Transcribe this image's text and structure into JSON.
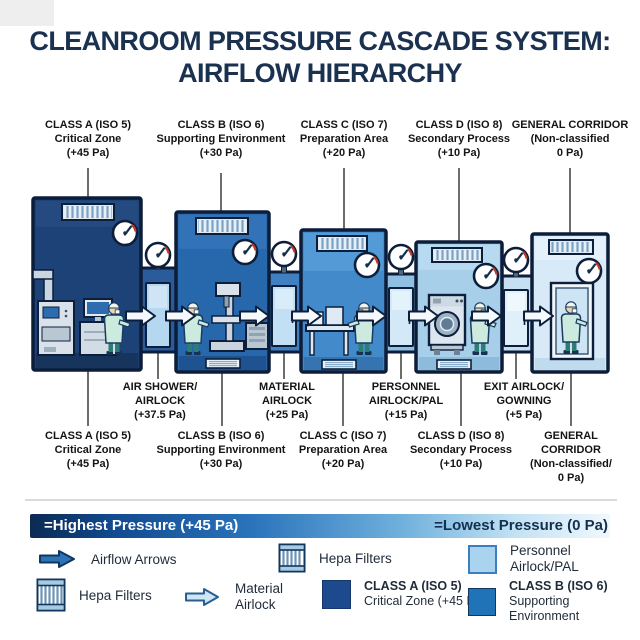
{
  "title": {
    "line1": "CLEANROOM PRESSURE CASCADE SYSTEM:",
    "line2": "AIRFLOW HIERARCHY"
  },
  "top_labels": [
    {
      "lines": [
        "CLASS A (ISO 5)",
        "Critical Zone",
        "(+45 Pa)"
      ]
    },
    {
      "lines": [
        "CLASS B (ISO 6)",
        "Supporting Environment",
        "(+30 Pa)"
      ]
    },
    {
      "lines": [
        "CLASS C (ISO 7)",
        "Preparation Area",
        "(+20 Pa)"
      ]
    },
    {
      "lines": [
        "CLASS D (ISO 8)",
        "Secondary Process",
        "(+10 Pa)"
      ]
    },
    {
      "lines": [
        "GENERAL CORRIDOR",
        "(Non-classified",
        "0 Pa)"
      ]
    }
  ],
  "airlock_labels": [
    {
      "lines": [
        "AIR SHOWER/",
        "AIRLOCK",
        "(+37.5 Pa)"
      ]
    },
    {
      "lines": [
        "MATERIAL",
        "AIRLOCK",
        "(+25 Pa)"
      ]
    },
    {
      "lines": [
        "PERSONNEL",
        "AIRLOCK/PAL",
        "(+15 Pa)"
      ]
    },
    {
      "lines": [
        "EXIT AIRLOCK/",
        "GOWNING",
        "(+5 Pa)"
      ]
    }
  ],
  "bottom_labels": [
    {
      "lines": [
        "CLASS A (ISO 5)",
        "Critical Zone",
        "(+45 Pa)"
      ]
    },
    {
      "lines": [
        "CLASS B (ISO 6)",
        "Supporting Environment",
        "(+30 Pa)"
      ]
    },
    {
      "lines": [
        "CLASS C (ISO 7)",
        "Preparation Area",
        "(+20 Pa)"
      ]
    },
    {
      "lines": [
        "CLASS D (ISO 8)",
        "Secondary Process",
        "(+10 Pa)"
      ]
    },
    {
      "lines": [
        "GENERAL",
        "CORRIDOR",
        "(Non-classified/",
        "0 Pa)"
      ]
    }
  ],
  "legend": {
    "gradient_left": "=Highest Pressure (+45 Pa)",
    "gradient_right": "=Lowest Pressure (0 Pa)",
    "airflow_arrows": "Airflow Arrows",
    "hepa_filters_1": "Hepa Filters",
    "material_line1": "Material",
    "material_line2": "Airlock",
    "hepa_filters_2": "Hepa Filters",
    "class_a_line1": "CLASS A (ISO 5)",
    "class_a_line2": "Critical Zone (+45 Pa)",
    "personnel_line1": "Personnel",
    "personnel_line2": "Airlock/PAL",
    "class_b_line1": "CLASS B (ISO 6)",
    "class_b_line2": "Supporting Environment"
  },
  "palette": {
    "class_a_room": "#1d4277",
    "class_b_room": "#2767ac",
    "class_c_room": "#428aca",
    "class_d_room": "#a7cfe9",
    "corridor_room": "#d8eaf7",
    "air_shower_airlock": "#2a5c9c",
    "material_airlock": "#3e80c1",
    "personnel_airlock": "#8fc0e4",
    "exit_airlock": "#c6e0f2",
    "outline": "#0d1e3a",
    "title_text": "#1a3150",
    "legend_class_a_swatch": "#1d4a8c",
    "legend_class_b_swatch": "#2173b8",
    "legend_personnel_swatch": "#a9d3ee"
  }
}
